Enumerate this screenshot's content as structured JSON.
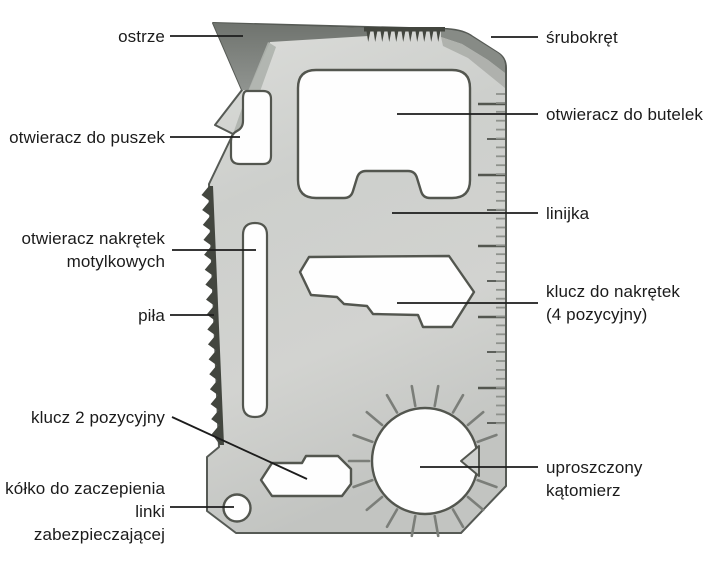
{
  "diagram": {
    "subject": "card multitool",
    "labels": {
      "ostrze": {
        "text": "ostrze",
        "side": "left"
      },
      "puszek": {
        "text": "otwieracz do puszek",
        "side": "left"
      },
      "motyl": {
        "text": "otwieracz nakrętek\nmotylkowych",
        "side": "left"
      },
      "pila": {
        "text": "piła",
        "side": "left"
      },
      "klucz2": {
        "text": "klucz 2 pozycyjny",
        "side": "left"
      },
      "kolko": {
        "text": "kółko do zaczepienia\nlinki zabezpieczającej",
        "side": "left"
      },
      "srubokret": {
        "text": "śrubokręt",
        "side": "right"
      },
      "butelek": {
        "text": "otwieracz do butelek",
        "side": "right"
      },
      "linijka": {
        "text": "linijka",
        "side": "right"
      },
      "klucz4": {
        "text": "klucz do nakrętek\n(4 pozycyjny)",
        "side": "right"
      },
      "katomierz": {
        "text": "uproszczony kątomierz",
        "side": "right"
      }
    },
    "colors": {
      "background": "#ffffff",
      "label_ink": "#1b1b1b",
      "leader_line": "#1c1c1c",
      "metal_light": "#d9dad7",
      "metal_mid": "#cbcdca",
      "metal_dark": "#bfc1be",
      "bevel_dark": "#7c807b",
      "bevel_mid": "#a9aca7",
      "edge_dark": "#4e524c",
      "tooth_dark": "#43463f",
      "tick_dark": "#53564f",
      "tick_gray": "#8f928d"
    }
  }
}
